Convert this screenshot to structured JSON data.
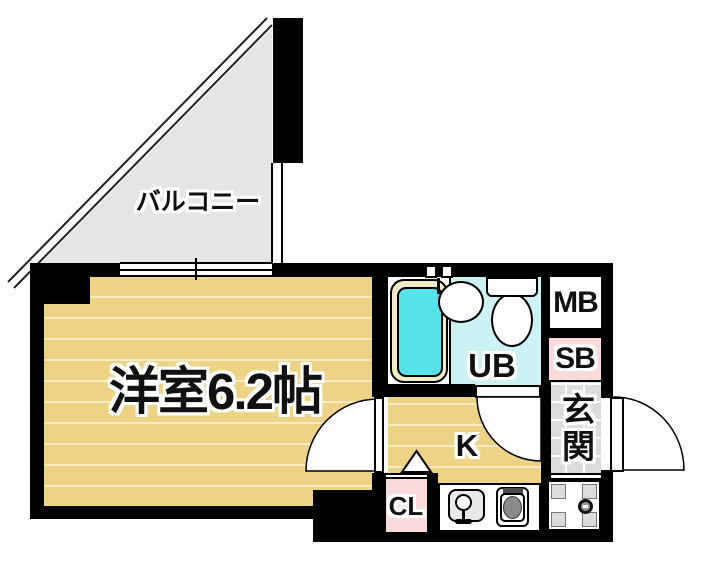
{
  "floorplan": {
    "balcony_label": "バルコニー",
    "main_room_label": "洋室6.2帖",
    "unit_bath_label": "UB",
    "meter_box_label": "MB",
    "shoe_box_label": "SB",
    "entrance_label": "玄関",
    "kitchen_label": "K",
    "closet_label": "CL",
    "colors": {
      "wall": "#000000",
      "room_floor": "#EDD385",
      "floor_line": "#F8ECC4",
      "balcony_floor": "#E5E5E5",
      "bath_floor": "#CDF2F4",
      "tub_water": "#55E2E8",
      "tub_rim": "#F1ECC6",
      "pink": "#FBDADC",
      "entrance_tile": "#DCDCDC"
    }
  }
}
